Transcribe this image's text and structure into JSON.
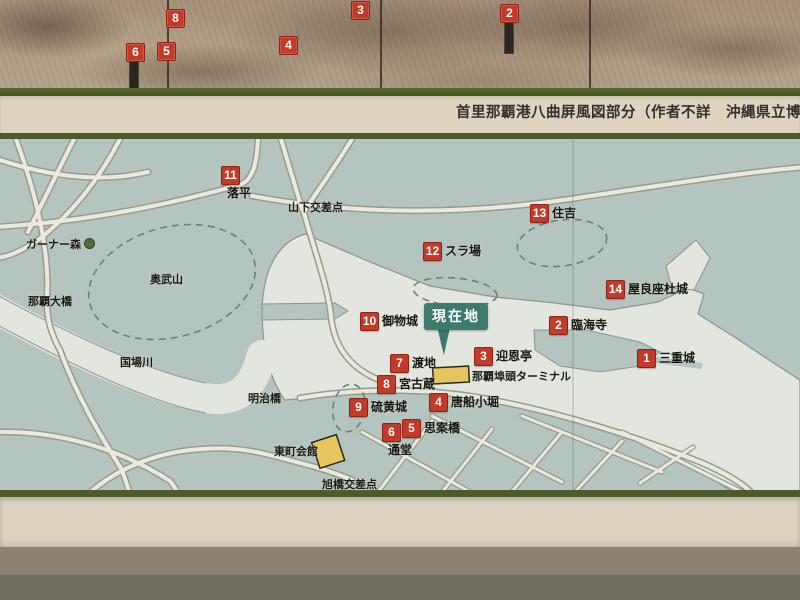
{
  "sign": {
    "caption": "首里那覇港八曲屏風図部分（作者不詳　沖縄県立博物館蔵",
    "painting_markers": [
      {
        "num": "8"
      },
      {
        "num": "6"
      },
      {
        "num": "5"
      },
      {
        "num": "4"
      },
      {
        "num": "3"
      },
      {
        "num": "2"
      }
    ],
    "map": {
      "current_location_label": "現在地",
      "markers": [
        {
          "num": "1",
          "label": "三重城"
        },
        {
          "num": "2",
          "label": "臨海寺"
        },
        {
          "num": "3",
          "label": "迎恩亭"
        },
        {
          "num": "4",
          "label": "唐船小堀"
        },
        {
          "num": "5",
          "label": "思案橋"
        },
        {
          "num": "6",
          "label": "通堂"
        },
        {
          "num": "7",
          "label": "渡地"
        },
        {
          "num": "8",
          "label": "宮古蔵"
        },
        {
          "num": "9",
          "label": "硫黄城"
        },
        {
          "num": "10",
          "label": "御物城"
        },
        {
          "num": "11",
          "label": "落平"
        },
        {
          "num": "12",
          "label": "スラ場"
        },
        {
          "num": "13",
          "label": "住吉"
        },
        {
          "num": "14",
          "label": "屋良座杜城"
        }
      ],
      "place_labels": [
        {
          "text": "山下交差点"
        },
        {
          "text": "ガーナー森"
        },
        {
          "text": "奥武山"
        },
        {
          "text": "那覇大橋"
        },
        {
          "text": "国場川"
        },
        {
          "text": "明治橋"
        },
        {
          "text": "東町会館"
        },
        {
          "text": "旭橋交差点"
        },
        {
          "text": "那覇埠頭ターミナル"
        }
      ]
    },
    "colors": {
      "marker_red": "#c23b2a",
      "current_location_teal": "#3d7b6e",
      "map_land": "#b4c4be",
      "map_water": "#e3e6df",
      "frame_cream": "#ddd4bf",
      "border_green": "#4d5b2c",
      "building_yellow": "#e5c55c"
    }
  }
}
